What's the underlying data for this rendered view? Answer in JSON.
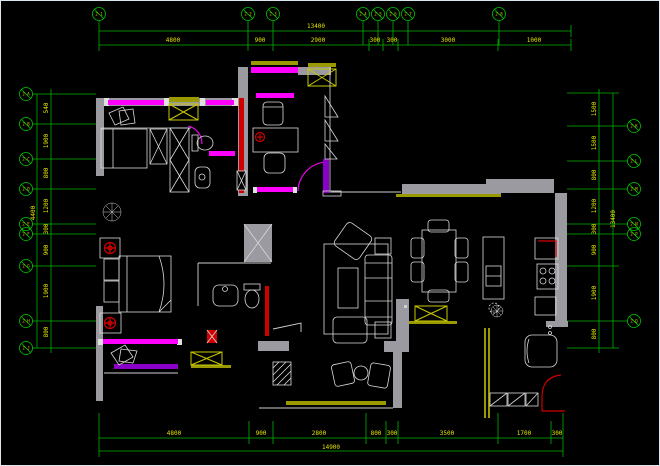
{
  "drawing": {
    "type_label": "apartment-floor-plan",
    "colors": {
      "background": "#000000",
      "dimension_line": "#00B400",
      "dimension_text": "#E3E300",
      "grid_bubble": "#00C800",
      "wall_gray": "#9A9AA0",
      "furniture_white": "#DADADA",
      "window_magenta": "#FF00FF",
      "window_purple": "#8A00C8",
      "accent_red": "#D00000",
      "accent_khaki": "#9A9A00",
      "ac_box_yellow": "#C8C800"
    },
    "grid_axes": {
      "top": [
        "2-1",
        "2-2",
        "2-3",
        "2-4",
        "2-5",
        "2-6",
        "2-7",
        "2-8"
      ],
      "left": [
        "2-A",
        "2-B",
        "2-C",
        "2-D",
        "2-E",
        "2-F",
        "2-G",
        "2-H",
        "2-J"
      ],
      "right": [
        "2-K",
        "2-L",
        "2-M",
        "2-N",
        "2-P",
        "2-Q"
      ]
    },
    "dimensions": {
      "top": {
        "segments": [
          "4800",
          "900",
          "2900",
          "300",
          "300",
          "3000",
          "1000"
        ],
        "overall": "13400"
      },
      "bottom": {
        "segments": [
          "4800",
          "900",
          "2800",
          "800",
          "300",
          "3500",
          "1700",
          "300"
        ],
        "overall": "14900"
      },
      "left": {
        "segments": [
          "540",
          "1900",
          "800",
          "1200",
          "300",
          "900",
          "1900",
          "800"
        ],
        "outer": "4400"
      },
      "right": {
        "segments": [
          "1500",
          "1500",
          "800",
          "1200",
          "300",
          "900",
          "1900",
          "800"
        ],
        "overall": "13400"
      }
    }
  }
}
